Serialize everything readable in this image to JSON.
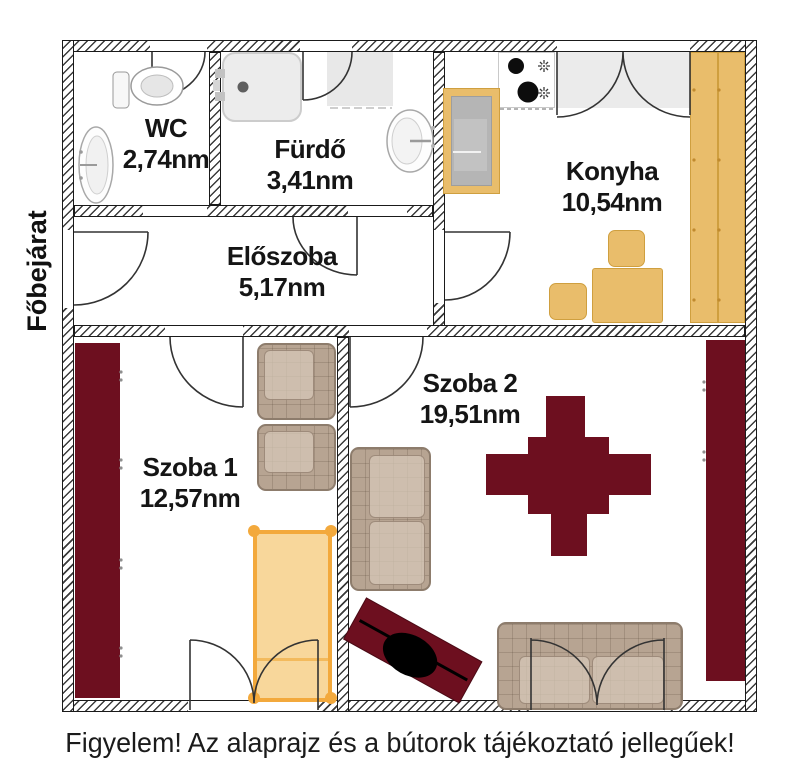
{
  "labels": {
    "entrance": "Főbejárat",
    "caption": "Figyelem! Az alaprajz és a bútorok tájékoztató jellegűek!"
  },
  "rooms": [
    {
      "name": "WC",
      "area": "2,74nm"
    },
    {
      "name": "Fürdő",
      "area": "3,41nm"
    },
    {
      "name": "Előszoba",
      "area": "5,17nm"
    },
    {
      "name": "Konyha",
      "area": "10,54nm"
    },
    {
      "name": "Szoba 1",
      "area": "12,57nm"
    },
    {
      "name": "Szoba 2",
      "area": "19,51nm"
    }
  ],
  "colors": {
    "furniture_dark": "#6d0f1f",
    "furniture_wood": "#e9bd6b",
    "upholstery": "#b7a492",
    "bed_frame": "#f3a93c",
    "bed_fill": "#f8d9a0",
    "wall_outline": "#1a1a1a"
  },
  "furniture": {
    "wc": [
      "toilet",
      "washbasin"
    ],
    "furdo": [
      "shower-tray",
      "washbasin",
      "window"
    ],
    "konyha": [
      "fridge",
      "stove-hob",
      "window-balcony-door",
      "tall-cabinet",
      "table",
      "chair",
      "chair"
    ],
    "szoba1": [
      "wardrobe",
      "armchair",
      "armchair",
      "bed",
      "balcony-double-door"
    ],
    "szoba2": [
      "sofa",
      "dining-table",
      "chair",
      "chair",
      "chair",
      "chair",
      "desk-with-chair",
      "sofa",
      "wardrobe",
      "balcony-double-door"
    ]
  }
}
